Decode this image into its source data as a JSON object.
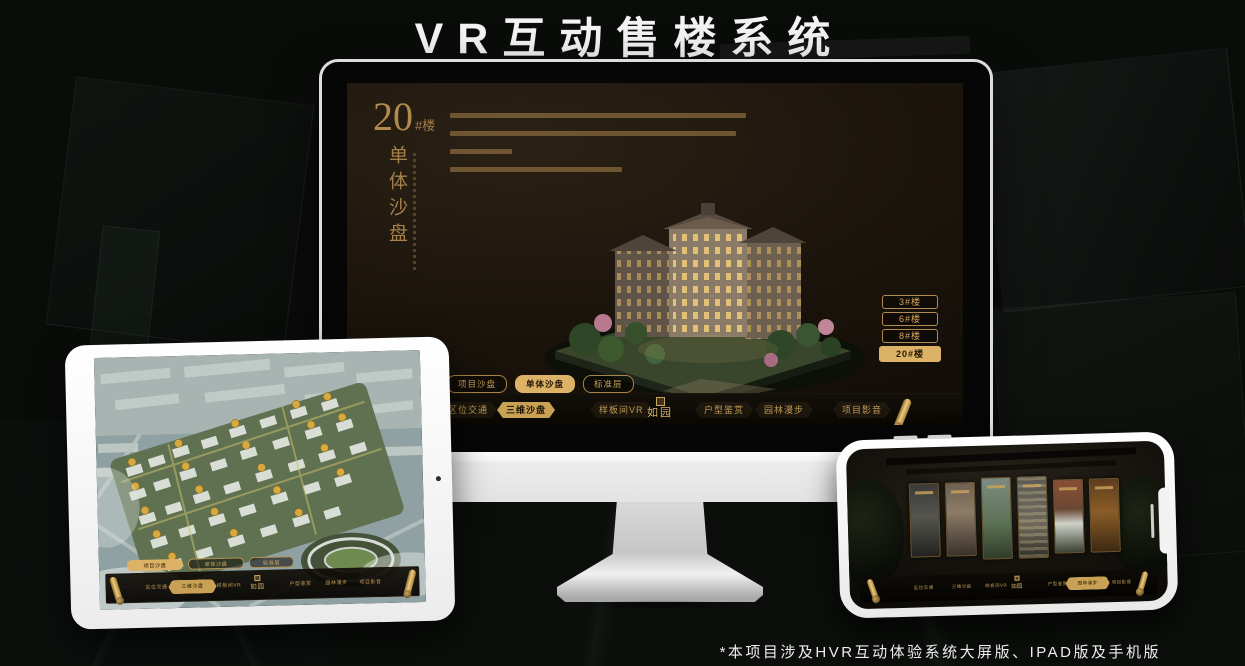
{
  "title": "VR互动售楼系统",
  "footnote": "*本项目涉及HVR互动体验系统大屏版、IPAD版及手机版",
  "brand": {
    "logo_text": "如园"
  },
  "colors": {
    "gold": "#c9a155",
    "gold_bright": "#dcb267",
    "screen_brown": "#1b140c",
    "background": "#0a0c0a"
  },
  "monitor": {
    "headline": {
      "number": "20",
      "suffix": "#楼",
      "vertical_label": "单体沙盘"
    },
    "floor_buttons": [
      {
        "label": "3#楼",
        "selected": false
      },
      {
        "label": "6#楼",
        "selected": false
      },
      {
        "label": "8#楼",
        "selected": false
      },
      {
        "label": "20#楼",
        "selected": true
      }
    ],
    "tabs": [
      {
        "label": "项目沙盘",
        "selected": false
      },
      {
        "label": "单体沙盘",
        "selected": true
      },
      {
        "label": "标准层",
        "selected": false
      }
    ],
    "nav_items": [
      {
        "label": "区位交通",
        "selected": false
      },
      {
        "label": "三维沙盘",
        "selected": true
      },
      {
        "label": "样板间VR",
        "selected": false
      },
      {
        "label": "户型鉴赏",
        "selected": false
      },
      {
        "label": "园林漫步",
        "selected": false
      },
      {
        "label": "项目影音",
        "selected": false
      }
    ]
  },
  "tablet": {
    "tabs": [
      {
        "label": "项目沙盘",
        "selected": true
      },
      {
        "label": "单体沙盘",
        "selected": false
      },
      {
        "label": "标准层",
        "selected": false
      }
    ],
    "nav_items": [
      {
        "label": "区位交通",
        "selected": false
      },
      {
        "label": "三维沙盘",
        "selected": true
      },
      {
        "label": "样板间VR",
        "selected": false
      },
      {
        "label": "户型鉴赏",
        "selected": false
      },
      {
        "label": "园林漫步",
        "selected": false
      },
      {
        "label": "项目影音",
        "selected": false
      }
    ]
  },
  "phone": {
    "nav_items": [
      {
        "label": "区位交通",
        "selected": false
      },
      {
        "label": "三维沙盘",
        "selected": false
      },
      {
        "label": "样板间VR",
        "selected": false
      },
      {
        "label": "户型鉴赏",
        "selected": false
      },
      {
        "label": "园林漫步",
        "selected": true
      },
      {
        "label": "项目影音",
        "selected": false
      }
    ]
  }
}
